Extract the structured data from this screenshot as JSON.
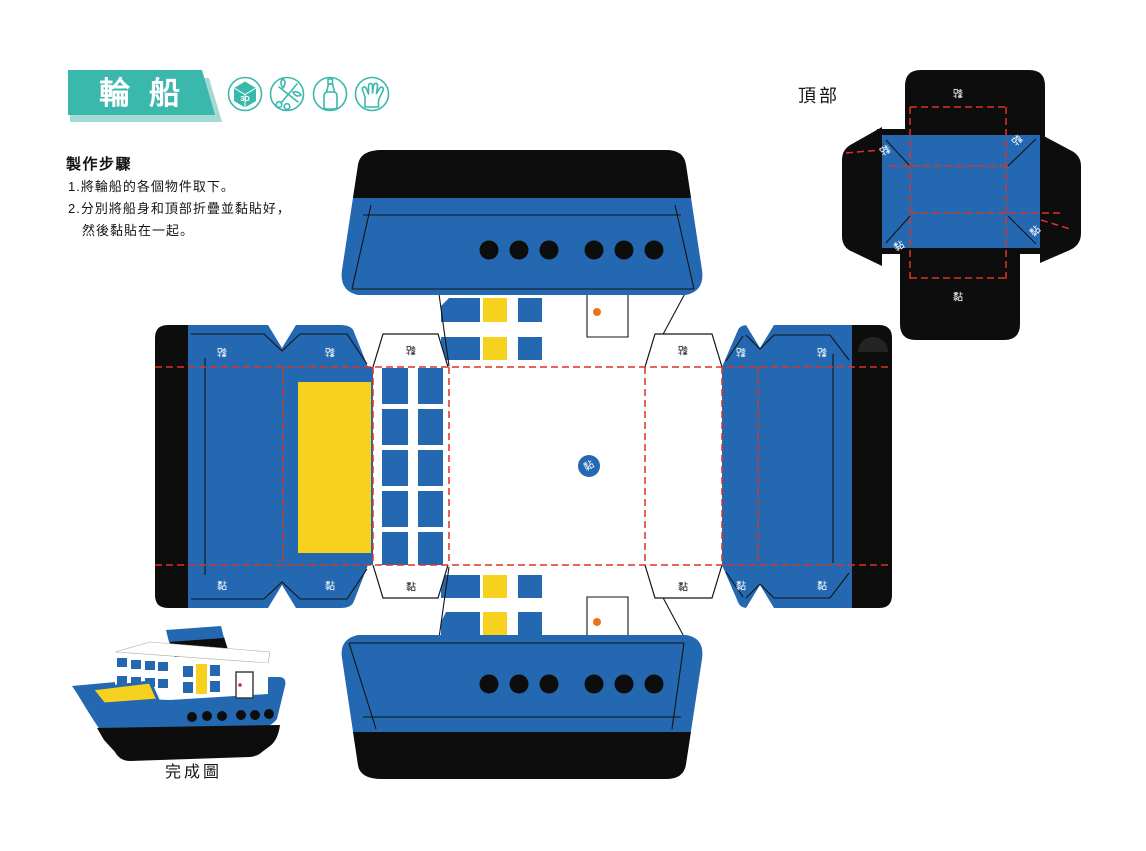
{
  "header": {
    "title": "輪船",
    "badge_3d_text": "3D",
    "tool_icons": [
      "3d-model",
      "scissors",
      "glue-bottle",
      "hand"
    ]
  },
  "instructions": {
    "heading": "製作步驟",
    "step_1": "1.將輪船的各個物件取下。",
    "step_2": "2.分別將船身和頂部折疊並黏貼好，",
    "step_2_cont": "然後黏貼在一起。"
  },
  "templates": {
    "top_piece_label": "頂部",
    "glue_tab_label": "黏"
  },
  "completed_figure": {
    "caption": "完成圖"
  },
  "colors": {
    "teal": "#3BB8AC",
    "teal_light": "#A3DAD2",
    "blue": "#2368B0",
    "yellow": "#F6D21F",
    "black_ink": "#0D0D0D",
    "fold_red": "#DD3326",
    "orange": "#E9731D"
  }
}
